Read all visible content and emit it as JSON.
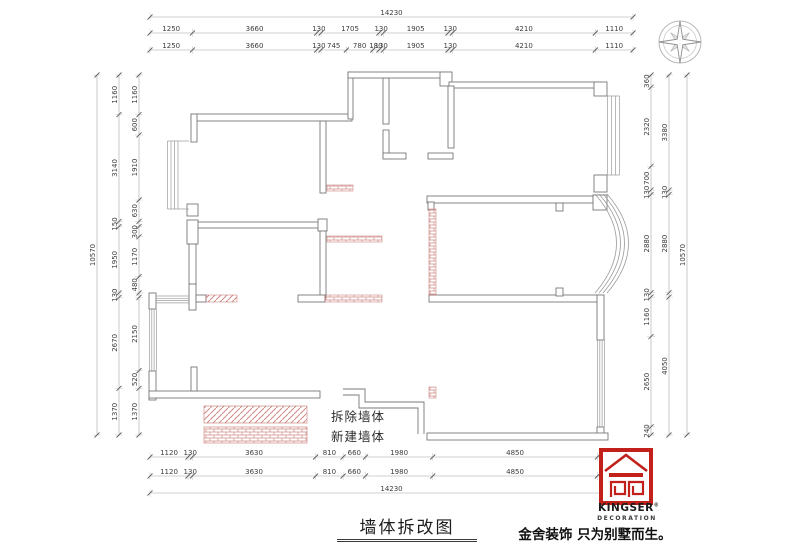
{
  "title": "墙体拆改图",
  "legend": {
    "demolish_label": "拆除墙体",
    "new_label": "新建墙体"
  },
  "logo": {
    "brand": "KINGSER",
    "reg": "®",
    "sub": "DECORATION",
    "tagline": "金舍装饰 只为别墅而生。"
  },
  "colors": {
    "wall": "#787878",
    "dimension": "#a3a3a3",
    "hatch_red": "#c0706c",
    "logo_red": "#c1211a"
  },
  "dim_chains": [
    {
      "id": "top-overall",
      "orient": "h",
      "line": 17,
      "start": 150,
      "end": 633,
      "values": [
        14230
      ],
      "labels": [
        "14230"
      ]
    },
    {
      "id": "top-outer",
      "orient": "h",
      "line": 33,
      "start": 150,
      "end": 633,
      "values": [
        1250,
        3660,
        130,
        1705,
        130,
        1905,
        130,
        4210,
        1110
      ],
      "labels": [
        "1250",
        "3660",
        "130",
        "1705",
        "130",
        "1905",
        "130",
        "4210",
        "1110"
      ]
    },
    {
      "id": "top-inner",
      "orient": "h",
      "line": 50,
      "start": 150,
      "end": 633,
      "values": [
        1250,
        3660,
        130,
        745,
        780,
        180,
        130,
        1905,
        130,
        4210,
        1110
      ],
      "labels": [
        "1250",
        "3660",
        "130",
        "745",
        "780",
        "180",
        "130",
        "1905",
        "130",
        "4210",
        "1110"
      ]
    },
    {
      "id": "bottom-inner",
      "orient": "h",
      "line": 457,
      "start": 150,
      "end": 633,
      "values": [
        1120,
        130,
        3630,
        810,
        660,
        1980,
        4850,
        1050
      ],
      "labels": [
        "1120",
        "130",
        "3630",
        "810",
        "660",
        "1980",
        "4850",
        "1050"
      ]
    },
    {
      "id": "bottom-outer",
      "orient": "h",
      "line": 476,
      "start": 150,
      "end": 633,
      "values": [
        1120,
        130,
        3630,
        810,
        660,
        1980,
        4850,
        1050
      ],
      "labels": [
        "1120",
        "130",
        "3630",
        "810",
        "660",
        "1980",
        "4850",
        "1050"
      ]
    },
    {
      "id": "bottom-overall",
      "orient": "h",
      "line": 493,
      "start": 150,
      "end": 633,
      "values": [
        14230
      ],
      "labels": [
        "14230"
      ]
    },
    {
      "id": "left-overall",
      "orient": "v",
      "line": 97,
      "start": 75,
      "end": 435,
      "values": [
        10570
      ],
      "labels": [
        "10570"
      ]
    },
    {
      "id": "left-mid",
      "orient": "v",
      "line": 119,
      "start": 75,
      "end": 435,
      "values": [
        1160,
        3140,
        150,
        1950,
        130,
        2670,
        1370
      ],
      "labels": [
        "1160",
        "3140",
        "150",
        "1950",
        "130",
        "2670",
        "1370"
      ]
    },
    {
      "id": "left-inner",
      "orient": "v",
      "line": 139,
      "start": 75,
      "end": 435,
      "values": [
        1160,
        600,
        1910,
        630,
        150,
        300,
        1170,
        480,
        130,
        2150,
        520,
        1370
      ],
      "labels": [
        "1160",
        "600",
        "1910",
        "630",
        "",
        "300",
        "1170",
        "480",
        "",
        "2150",
        "520",
        "1370"
      ]
    },
    {
      "id": "right-inner",
      "orient": "v",
      "line": 651,
      "start": 75,
      "end": 435,
      "values": [
        360,
        2320,
        700,
        130,
        2880,
        130,
        1160,
        2650,
        240
      ],
      "labels": [
        "360",
        "2320",
        "700",
        "130",
        "2880",
        "130",
        "1160",
        "2650",
        "240"
      ]
    },
    {
      "id": "right-mid",
      "orient": "v",
      "line": 669,
      "start": 75,
      "end": 435,
      "values": [
        3380,
        130,
        2880,
        130,
        4050
      ],
      "labels": [
        "3380",
        "130",
        "2880",
        "",
        "4050"
      ]
    },
    {
      "id": "right-overall",
      "orient": "v",
      "line": 687,
      "start": 75,
      "end": 435,
      "values": [
        10570
      ],
      "labels": [
        "10570"
      ]
    }
  ]
}
